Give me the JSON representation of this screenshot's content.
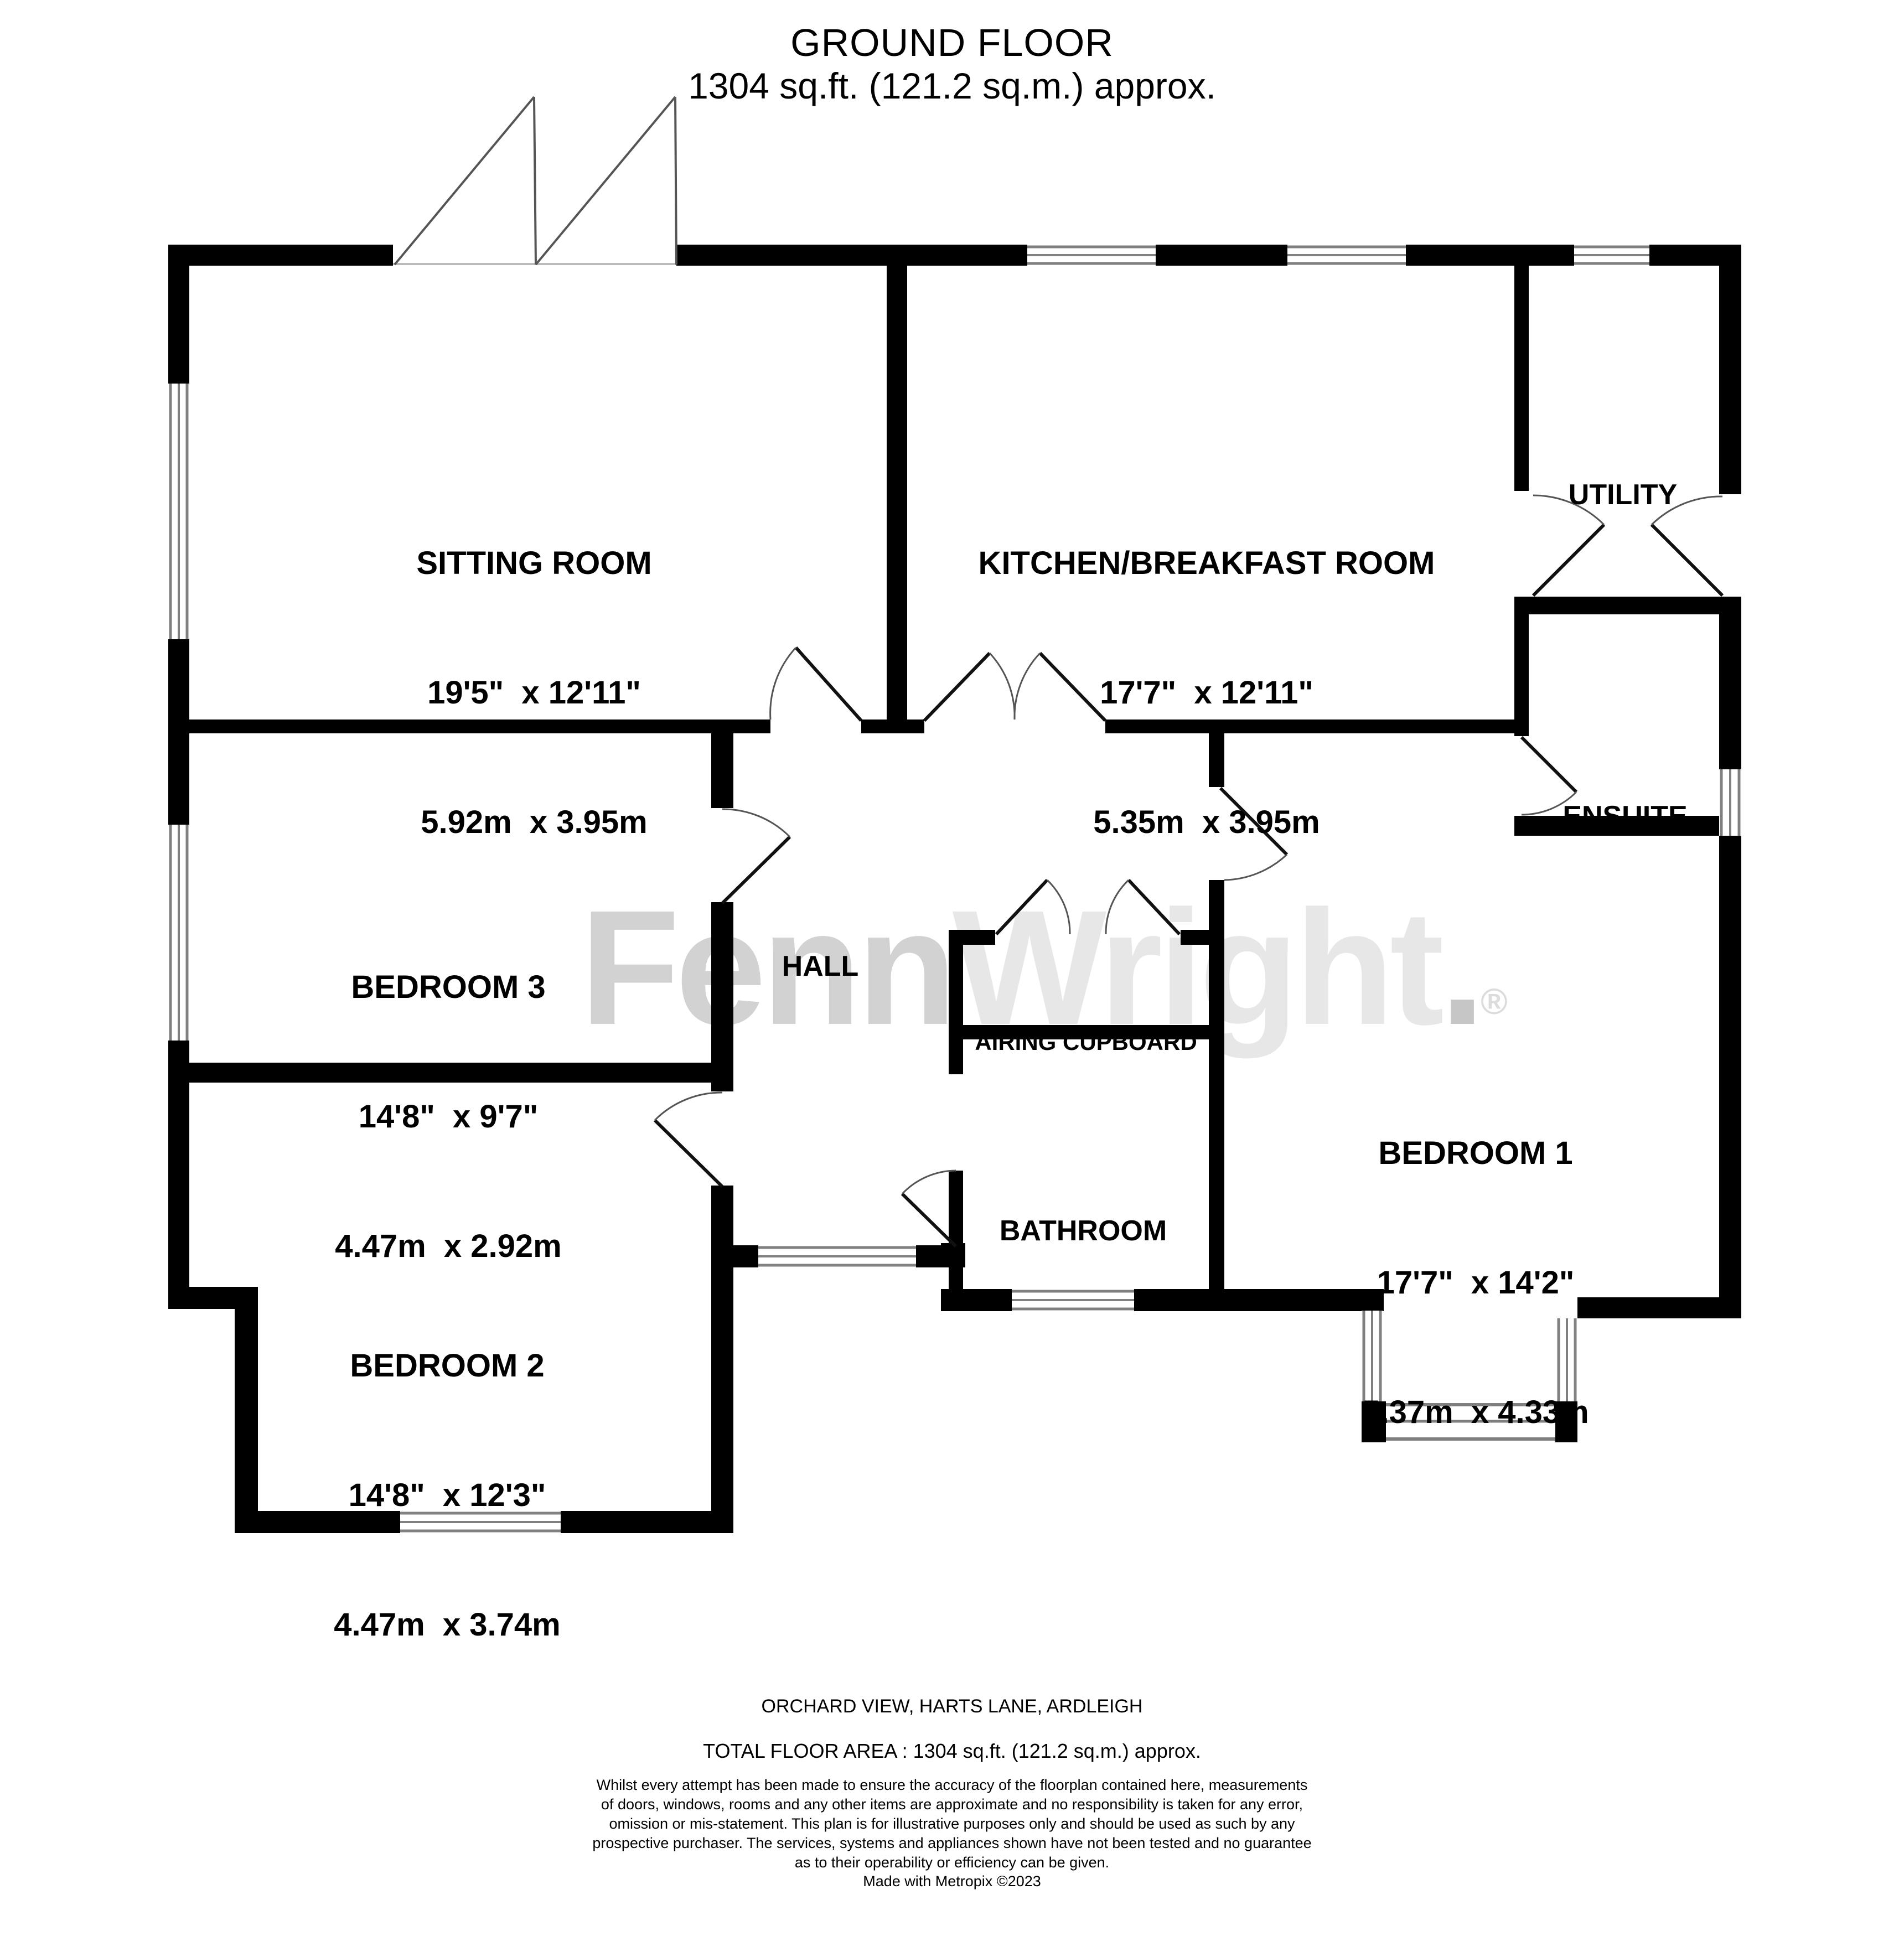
{
  "title": {
    "line1": "GROUND FLOOR",
    "line2": "1304 sq.ft. (121.2 sq.m.) approx."
  },
  "rooms": {
    "sitting": {
      "name": "SITTING ROOM",
      "imperial": "19'5\"  x 12'11\"",
      "metric": "5.92m  x 3.95m"
    },
    "kitchen": {
      "name": "KITCHEN/BREAKFAST ROOM",
      "imperial": "17'7\"  x 12'11\"",
      "metric": "5.35m  x 3.95m"
    },
    "utility": {
      "name": "UTILITY"
    },
    "ensuite": {
      "name": "ENSUITE"
    },
    "hall": {
      "name": "HALL"
    },
    "airing": {
      "name": "AIRING CUPBOARD"
    },
    "bathroom": {
      "name": "BATHROOM"
    },
    "bedroom1": {
      "name": "BEDROOM 1",
      "imperial": "17'7\"  x 14'2\"",
      "metric": "5.37m  x 4.33m"
    },
    "bedroom2": {
      "name": "BEDROOM 2",
      "imperial": "14'8\"  x 12'3\"",
      "metric": "4.47m  x 3.74m"
    },
    "bedroom3": {
      "name": "BEDROOM 3",
      "imperial": "14'8\"  x 9'7\"",
      "metric": "4.47m  x 2.92m"
    }
  },
  "watermark": {
    "part1": "Fenn",
    "part2": "Wright",
    "registered": "®",
    "dot": "."
  },
  "footer": {
    "address": "ORCHARD VIEW, HARTS LANE, ARDLEIGH",
    "total": "TOTAL FLOOR AREA : 1304 sq.ft. (121.2 sq.m.) approx.",
    "disclaimer": [
      "Whilst every attempt has been made to ensure the accuracy of the floorplan contained here, measurements",
      "of doors, windows, rooms and any other items are approximate and no responsibility is taken for any error,",
      "omission or mis-statement. This plan is for illustrative purposes only and should be used as such by any",
      "prospective purchaser. The services, systems and appliances shown have not been tested and no guarantee",
      "as to their operability or efficiency can be given."
    ],
    "credit": "Made with Metropix ©2023"
  }
}
